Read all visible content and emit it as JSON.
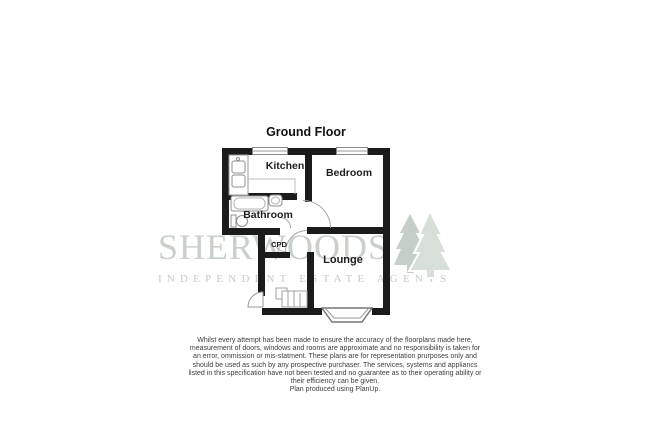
{
  "page": {
    "background_color": "#ffffff"
  },
  "plan": {
    "title": "Ground Floor",
    "wall_color": "#1b1b1b",
    "rooms": {
      "kitchen": "Kitchen",
      "bedroom": "Bedroom",
      "bathroom": "Bathroom",
      "cpd": "CPD",
      "lounge": "Lounge"
    }
  },
  "watermark": {
    "brand": "SHERWOODS",
    "tagline": "INDEPENDENT ESTATE AGENTS",
    "color": "#c9d0ca",
    "logo_icon": "pine-trees-icon"
  },
  "disclaimer": {
    "lines": [
      "Whilst every attempt has been made to ensure the accuracy of the floorplans made here,",
      "measurement of doors, windows and rooms are approximate and no responsibility is taken for",
      "an error, ommission or mis-statment. These plans are for representation prurposes only and",
      "should be used as such by any prospective purchaser. The services, systems and appliancs",
      "listed in this specification have not been tested and no guarantee as to their operating ability or",
      "their efficiency can be given.",
      "Plan produced using PlanUp."
    ]
  }
}
